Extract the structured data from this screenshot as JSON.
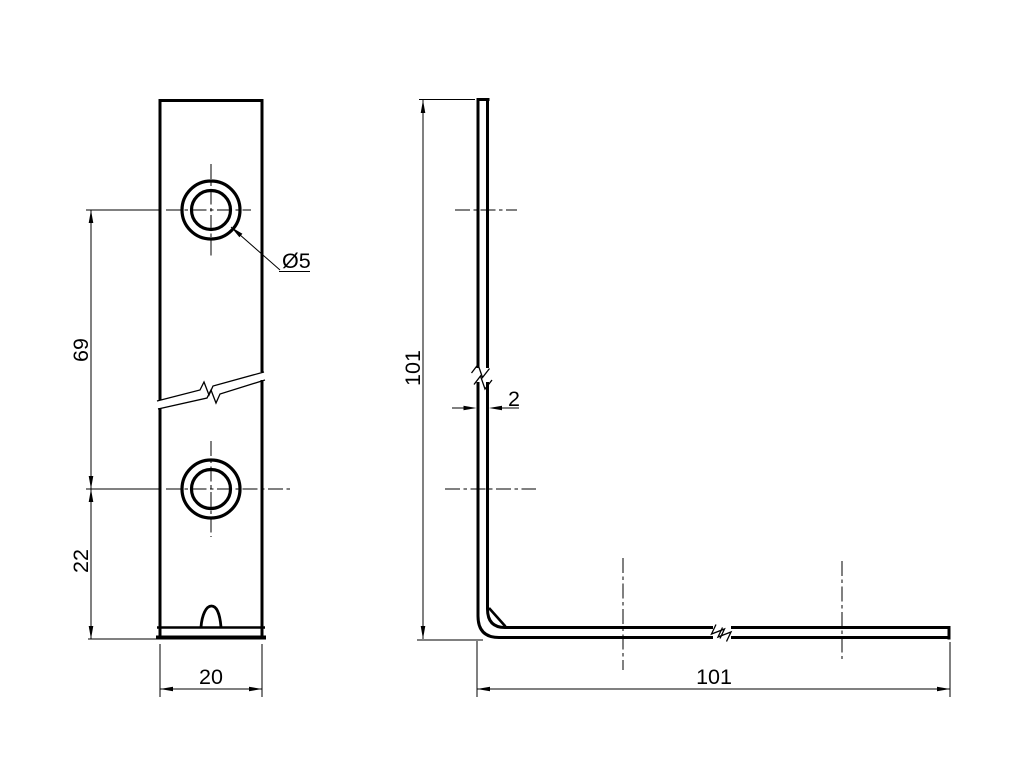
{
  "drawing": {
    "kind": "technical-drawing-two-views",
    "subject": "L-shaped corner bracket with two countersunk holes",
    "colors": {
      "background": "#ffffff",
      "line": "#000000"
    },
    "labels": {
      "hole_spacing": "69",
      "edge_to_hole": "22",
      "width": "20",
      "hole_diameter": "Ø5",
      "height": "101",
      "thickness": "2",
      "length": "101"
    }
  }
}
